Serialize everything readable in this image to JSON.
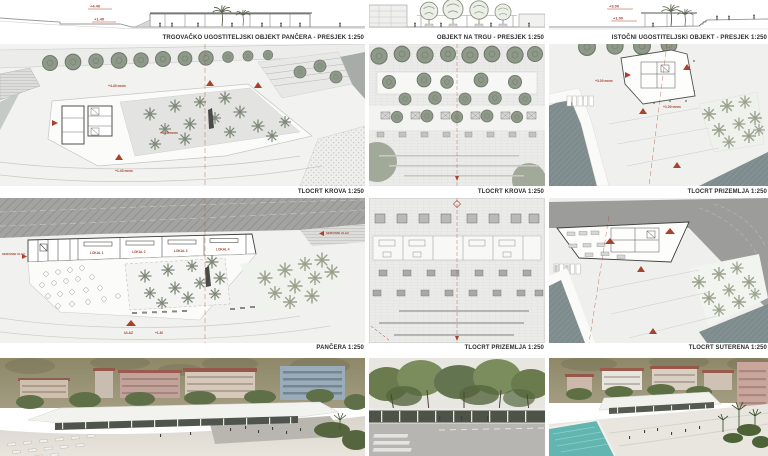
{
  "board": {
    "background": "#ffffff",
    "accent_red": "#a8432b",
    "caption_color": "#2e2e2e"
  },
  "sections": {
    "pancera": {
      "caption": "TRGOVAČKO UGOSTITELJSKI OBJEKT PANČERA - PRESJEK 1:250",
      "elev_a": "+4.40",
      "elev_b": "+1.40"
    },
    "trg": {
      "caption": "OBJEKT NA TRGU - PRESJEK 1:250"
    },
    "istocni": {
      "caption": "ISTOČNI UGOSTITELJSKI OBJEKT - PRESJEK 1:250",
      "elev_a": "+3.00",
      "elev_b": "+1.00"
    }
  },
  "plans": {
    "krov_pancera": {
      "caption": "TLOCRT KROVA 1:250",
      "elev_a": "+4.40 mnm",
      "elev_b": "+4.40 mnm",
      "elev_c": "+1.40 mnm"
    },
    "krov_trg": {
      "caption": "TLOCRT KROVA 1:250"
    },
    "prizemlje_istocni": {
      "caption": "TLOCRT PRIZEMLJA 1:250",
      "elev_a": "+3.00 mnm",
      "elev_b": "+1.00 mnm"
    },
    "pancera": {
      "caption": "PANČERA 1:250",
      "lokali": [
        "LOKAL 1",
        "LOKAL 2",
        "LOKAL 3",
        "LOKAL 4"
      ],
      "ulaz": "ULAZ",
      "servisni_ulaz": "SERVISNI ULAZ",
      "elev_a": "+1.40"
    },
    "prizemlje_trg": {
      "caption": "TLOCRT PRIZEMLJA 1:250"
    },
    "suterena": {
      "caption": "TLOCRT SUTERENA 1:250"
    }
  }
}
